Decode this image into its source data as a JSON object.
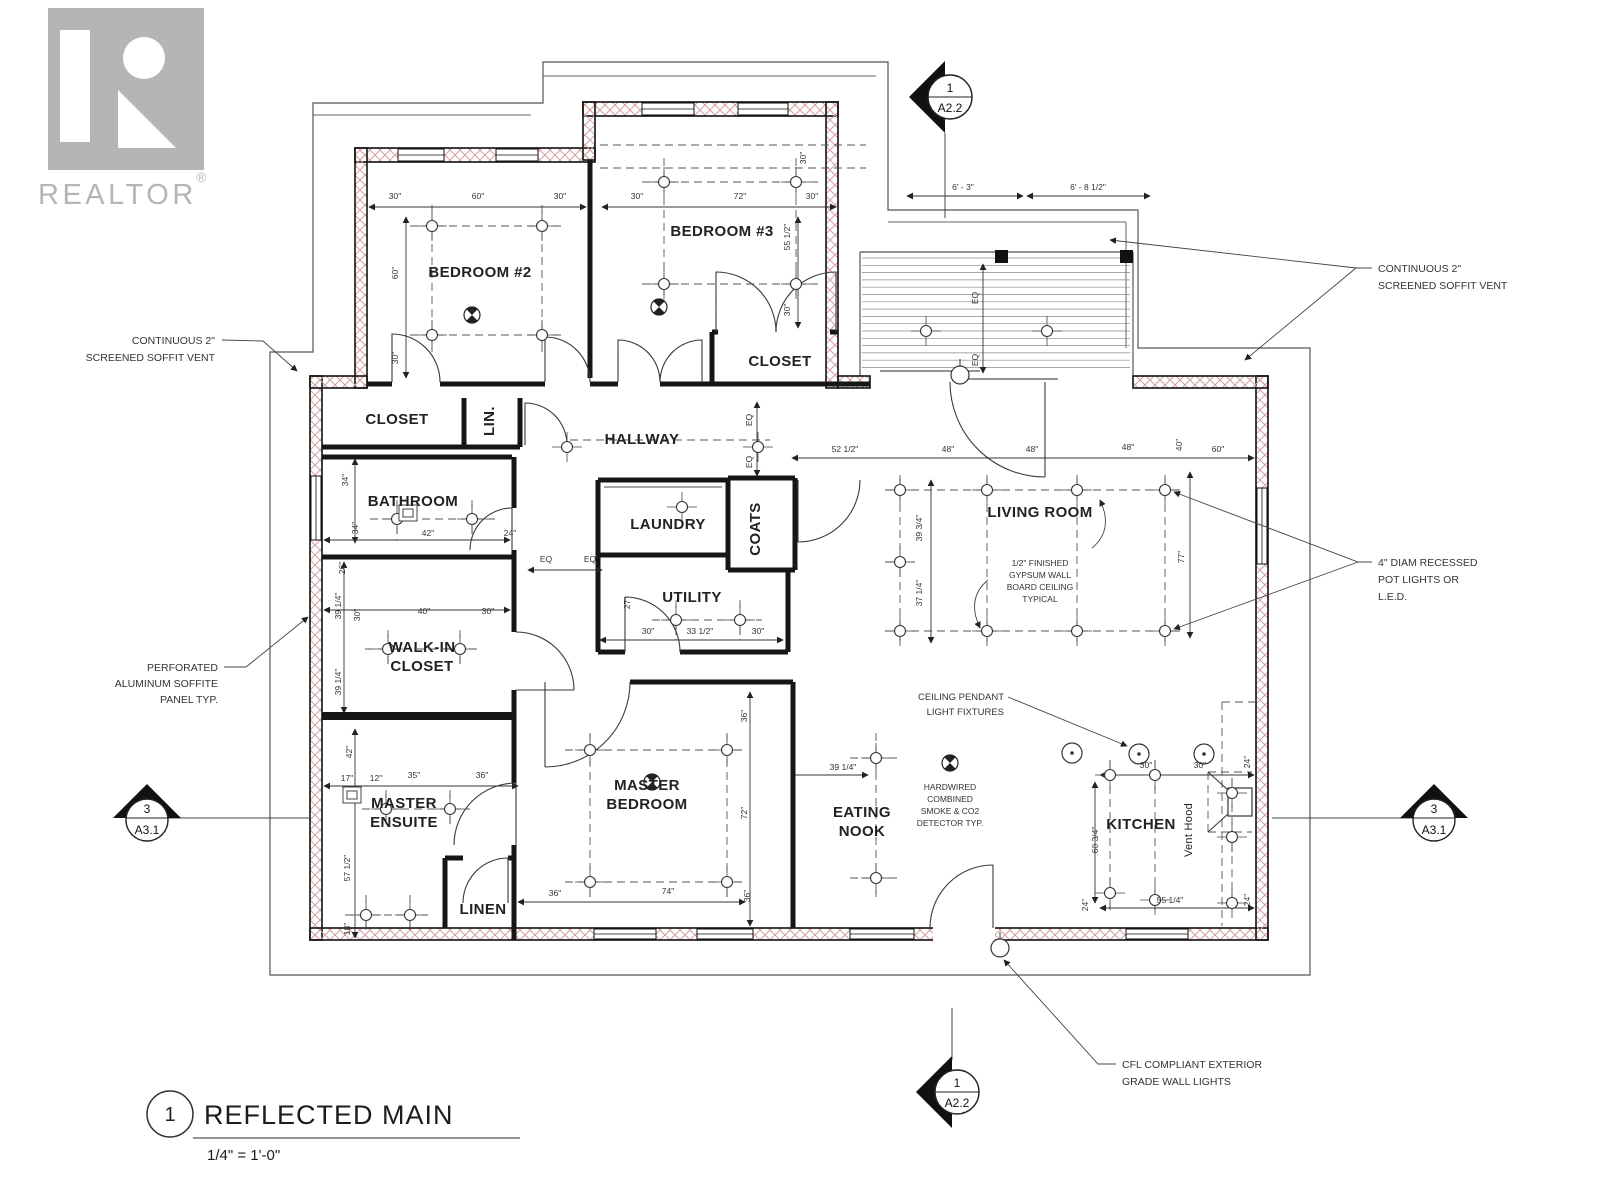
{
  "watermark": {
    "brand": "REALTOR",
    "registered": "®"
  },
  "title_block": {
    "detail_number": "1",
    "title": "REFLECTED MAIN",
    "scale": "1/4\" = 1'-0\""
  },
  "section_markers": {
    "top": {
      "number": "1",
      "sheet": "A2.2"
    },
    "bottom": {
      "number": "1",
      "sheet": "A2.2"
    },
    "left": {
      "number": "3",
      "sheet": "A3.1"
    },
    "right": {
      "number": "3",
      "sheet": "A3.1"
    }
  },
  "colors": {
    "wall_hatch": "#d5a0a0",
    "line": "#222222",
    "watermark_gray": "#a3a3a3"
  },
  "plan": {
    "rooms": [
      {
        "label": "BEDROOM #2",
        "x": 480,
        "y": 277
      },
      {
        "label": "BEDROOM #3",
        "x": 722,
        "y": 236
      },
      {
        "label": "CLOSET",
        "x": 780,
        "y": 366
      },
      {
        "label": "CLOSET",
        "x": 397,
        "y": 424
      },
      {
        "label": "LIN.",
        "x": 494,
        "y": 421,
        "r": 1
      },
      {
        "label": "HALLWAY",
        "x": 642,
        "y": 444
      },
      {
        "label": "BATHROOM",
        "x": 413,
        "y": 506
      },
      {
        "label": "LAUNDRY",
        "x": 668,
        "y": 529
      },
      {
        "label": "COATS",
        "x": 760,
        "y": 529,
        "r": 1
      },
      {
        "label": "UTILITY",
        "x": 692,
        "y": 602
      },
      {
        "label": "WALK-IN\nCLOSET",
        "x": 422,
        "y": 652,
        "lh": 19
      },
      {
        "label": "MASTER\nENSUITE",
        "x": 404,
        "y": 808,
        "lh": 19
      },
      {
        "label": "LINEN",
        "x": 483,
        "y": 914
      },
      {
        "label": "MASTER\nBEDROOM",
        "x": 647,
        "y": 790,
        "lh": 19
      },
      {
        "label": "EATING\nNOOK",
        "x": 862,
        "y": 817,
        "lh": 19
      },
      {
        "label": "LIVING ROOM",
        "x": 1040,
        "y": 517
      },
      {
        "label": "KITCHEN",
        "x": 1141,
        "y": 829
      },
      {
        "label": "Vent Hood",
        "x": 1192,
        "y": 830,
        "r": 1,
        "small": 1
      }
    ],
    "dimension_labels": [
      {
        "t": "6' - 3\"",
        "x": 963,
        "y": 190
      },
      {
        "t": "6' - 8 1/2\"",
        "x": 1088,
        "y": 190
      },
      {
        "t": "30\"",
        "x": 395,
        "y": 199
      },
      {
        "t": "60\"",
        "x": 478,
        "y": 199
      },
      {
        "t": "30\"",
        "x": 560,
        "y": 199
      },
      {
        "t": "30\"",
        "x": 637,
        "y": 199
      },
      {
        "t": "72\"",
        "x": 740,
        "y": 199
      },
      {
        "t": "30\"",
        "x": 812,
        "y": 199
      },
      {
        "t": "30\"",
        "x": 806,
        "y": 158,
        "r": 1
      },
      {
        "t": "60\"",
        "x": 398,
        "y": 273,
        "r": 1
      },
      {
        "t": "30\"",
        "x": 398,
        "y": 358,
        "r": 1
      },
      {
        "t": "55 1/2\"",
        "x": 790,
        "y": 237,
        "r": 1
      },
      {
        "t": "30\"",
        "x": 790,
        "y": 310,
        "r": 1
      },
      {
        "t": "EQ",
        "x": 978,
        "y": 298,
        "r": 1
      },
      {
        "t": "EQ",
        "x": 978,
        "y": 360,
        "r": 1
      },
      {
        "t": "EQ",
        "x": 752,
        "y": 420,
        "r": 1
      },
      {
        "t": "EQ",
        "x": 752,
        "y": 462,
        "r": 1
      },
      {
        "t": "52 1/2\"",
        "x": 845,
        "y": 452
      },
      {
        "t": "48\"",
        "x": 948,
        "y": 452
      },
      {
        "t": "48\"",
        "x": 1032,
        "y": 452
      },
      {
        "t": "48\"",
        "x": 1128,
        "y": 450
      },
      {
        "t": "40\"",
        "x": 1182,
        "y": 445,
        "r": 1
      },
      {
        "t": "60\"",
        "x": 1218,
        "y": 452
      },
      {
        "t": "39 3/4\"",
        "x": 922,
        "y": 528,
        "r": 1
      },
      {
        "t": "37 1/4\"",
        "x": 922,
        "y": 593,
        "r": 1
      },
      {
        "t": "77\"",
        "x": 1184,
        "y": 557,
        "r": 1
      },
      {
        "t": "EQ",
        "x": 546,
        "y": 562
      },
      {
        "t": "EQ",
        "x": 590,
        "y": 562
      },
      {
        "t": "34\"",
        "x": 348,
        "y": 480,
        "r": 1
      },
      {
        "t": "34\"",
        "x": 358,
        "y": 528,
        "r": 1
      },
      {
        "t": "26\"",
        "x": 345,
        "y": 568,
        "r": 1
      },
      {
        "t": "42\"",
        "x": 428,
        "y": 536
      },
      {
        "t": "24\"",
        "x": 510,
        "y": 536
      },
      {
        "t": "27\"",
        "x": 630,
        "y": 603,
        "r": 1
      },
      {
        "t": "30\"",
        "x": 648,
        "y": 634
      },
      {
        "t": "33 1/2\"",
        "x": 700,
        "y": 634
      },
      {
        "t": "30\"",
        "x": 758,
        "y": 634
      },
      {
        "t": "39 1/4\"",
        "x": 341,
        "y": 606,
        "r": 1
      },
      {
        "t": "30\"",
        "x": 360,
        "y": 615,
        "r": 1
      },
      {
        "t": "40\"",
        "x": 424,
        "y": 614
      },
      {
        "t": "30\"",
        "x": 488,
        "y": 614
      },
      {
        "t": "39 1/4\"",
        "x": 341,
        "y": 682,
        "r": 1
      },
      {
        "t": "42\"",
        "x": 352,
        "y": 752,
        "r": 1
      },
      {
        "t": "17\"",
        "x": 347,
        "y": 781
      },
      {
        "t": "12\"",
        "x": 376,
        "y": 781
      },
      {
        "t": "35\"",
        "x": 414,
        "y": 778
      },
      {
        "t": "36\"",
        "x": 482,
        "y": 778
      },
      {
        "t": "57 1/2\"",
        "x": 350,
        "y": 868,
        "r": 1
      },
      {
        "t": "18\"",
        "x": 350,
        "y": 929,
        "r": 1
      },
      {
        "t": "36\"",
        "x": 555,
        "y": 896
      },
      {
        "t": "74\"",
        "x": 668,
        "y": 894
      },
      {
        "t": "36\"",
        "x": 747,
        "y": 716,
        "r": 1
      },
      {
        "t": "72\"",
        "x": 747,
        "y": 813,
        "r": 1
      },
      {
        "t": "36\"",
        "x": 750,
        "y": 896,
        "r": 1
      },
      {
        "t": "39 1/4\"",
        "x": 843,
        "y": 770
      },
      {
        "t": "30\"",
        "x": 1146,
        "y": 768
      },
      {
        "t": "30\"",
        "x": 1200,
        "y": 768
      },
      {
        "t": "24\"",
        "x": 1250,
        "y": 762,
        "r": 1
      },
      {
        "t": "60 3/4\"",
        "x": 1098,
        "y": 840,
        "r": 1
      },
      {
        "t": "55 1/4\"",
        "x": 1170,
        "y": 903
      },
      {
        "t": "24\"",
        "x": 1250,
        "y": 900,
        "r": 1
      },
      {
        "t": "24\"",
        "x": 1088,
        "y": 905,
        "r": 1
      }
    ],
    "annotations": [
      {
        "id": "soffit-left",
        "lines": [
          "CONTINUOUS 2\"",
          "SCREENED SOFFIT VENT"
        ],
        "x": 215,
        "y": 344,
        "lh": 17,
        "anchor": "end",
        "size": 10.5,
        "leaders": [
          [
            [
              222,
              340
            ],
            [
              263,
              341
            ],
            [
              297,
              371
            ]
          ]
        ]
      },
      {
        "id": "perforated-soffit",
        "lines": [
          "PERFORATED",
          "ALUMINUM SOFFITE",
          "PANEL TYP."
        ],
        "x": 218,
        "y": 671,
        "lh": 16,
        "anchor": "end",
        "size": 10.5,
        "leaders": [
          [
            [
              224,
              667
            ],
            [
              246,
              667
            ],
            [
              308,
              617
            ]
          ]
        ]
      },
      {
        "id": "soffit-right",
        "lines": [
          "CONTINUOUS 2\"",
          "SCREENED SOFFIT VENT"
        ],
        "x": 1378,
        "y": 272,
        "lh": 17,
        "anchor": "start",
        "size": 10.5,
        "leaders": [
          [
            [
              1372,
              268
            ],
            [
              1356,
              268
            ],
            [
              1110,
              240
            ]
          ],
          [
            [
              1356,
              268
            ],
            [
              1245,
              360
            ]
          ]
        ]
      },
      {
        "id": "pot-lights-note",
        "lines": [
          "4\" DIAM RECESSED",
          "POT LIGHTS OR",
          "L.E.D."
        ],
        "x": 1378,
        "y": 566,
        "lh": 17,
        "anchor": "start",
        "size": 10.5,
        "leaders": [
          [
            [
              1372,
              562
            ],
            [
              1358,
              562
            ],
            [
              1174,
              492
            ]
          ],
          [
            [
              1358,
              562
            ],
            [
              1174,
              629
            ]
          ]
        ]
      },
      {
        "id": "ceiling-pendant-note",
        "lines": [
          "CEILING PENDANT",
          "LIGHT FIXTURES"
        ],
        "x": 1004,
        "y": 700,
        "lh": 15,
        "anchor": "end",
        "size": 9.5,
        "leaders": [
          [
            [
              1008,
              697
            ],
            [
              1127,
              746
            ]
          ]
        ]
      },
      {
        "id": "smoke-detector-note",
        "lines": [
          "HARDWIRED",
          "COMBINED",
          "SMOKE & CO2",
          "DETECTOR TYP."
        ],
        "x": 950,
        "y": 790,
        "lh": 12,
        "anchor": "middle",
        "size": 8.5,
        "leaders": []
      },
      {
        "id": "gypsum-note",
        "lines": [
          "1/2\" FINISHED",
          "GYPSUM WALL",
          "BOARD CEILING",
          "TYPICAL"
        ],
        "x": 1040,
        "y": 566,
        "lh": 12,
        "anchor": "middle",
        "size": 8.5,
        "leaders": []
      },
      {
        "id": "cfl-note",
        "lines": [
          "CFL COMPLIANT EXTERIOR",
          "GRADE WALL LIGHTS"
        ],
        "x": 1122,
        "y": 1068,
        "lh": 17,
        "anchor": "start",
        "size": 10.5,
        "leaders": [
          [
            [
              1116,
              1064
            ],
            [
              1098,
              1064
            ],
            [
              1004,
              960
            ]
          ]
        ]
      }
    ],
    "symbols": {
      "pot_lights": [
        [
          432,
          226
        ],
        [
          542,
          226
        ],
        [
          432,
          335
        ],
        [
          542,
          335
        ],
        [
          664,
          182
        ],
        [
          796,
          182
        ],
        [
          664,
          284
        ],
        [
          796,
          284
        ],
        [
          567,
          447
        ],
        [
          758,
          447
        ],
        [
          682,
          507
        ],
        [
          676,
          620
        ],
        [
          740,
          620
        ],
        [
          397,
          519
        ],
        [
          472,
          519
        ],
        [
          388,
          649
        ],
        [
          460,
          649
        ],
        [
          386,
          809
        ],
        [
          450,
          809
        ],
        [
          366,
          915
        ],
        [
          410,
          915
        ],
        [
          590,
          750
        ],
        [
          727,
          750
        ],
        [
          590,
          882
        ],
        [
          727,
          882
        ],
        [
          876,
          758
        ],
        [
          876,
          878
        ],
        [
          900,
          490
        ],
        [
          987,
          490
        ],
        [
          1077,
          490
        ],
        [
          1165,
          490
        ],
        [
          900,
          562
        ],
        [
          900,
          631
        ],
        [
          987,
          631
        ],
        [
          1077,
          631
        ],
        [
          1165,
          631
        ],
        [
          926,
          331
        ],
        [
          1047,
          331
        ],
        [
          1110,
          775
        ],
        [
          1155,
          775
        ],
        [
          1232,
          793
        ],
        [
          1232,
          837
        ],
        [
          1110,
          893
        ],
        [
          1155,
          900
        ],
        [
          1232,
          903
        ]
      ],
      "pendant_lights": [
        [
          1072,
          753
        ],
        [
          1139,
          754
        ],
        [
          1204,
          754
        ]
      ],
      "ceiling_fixtures": [
        [
          472,
          315
        ],
        [
          659,
          307
        ],
        [
          652,
          782
        ],
        [
          950,
          763
        ]
      ],
      "exhaust_fans": [
        [
          408,
          513
        ],
        [
          352,
          795
        ]
      ],
      "wall_lights": [
        [
          960,
          375
        ],
        [
          1000,
          948
        ]
      ]
    },
    "deck_slats": {
      "x1": 862,
      "x2": 1130,
      "y1": 258,
      "y2": 372,
      "step": 7.3
    }
  }
}
